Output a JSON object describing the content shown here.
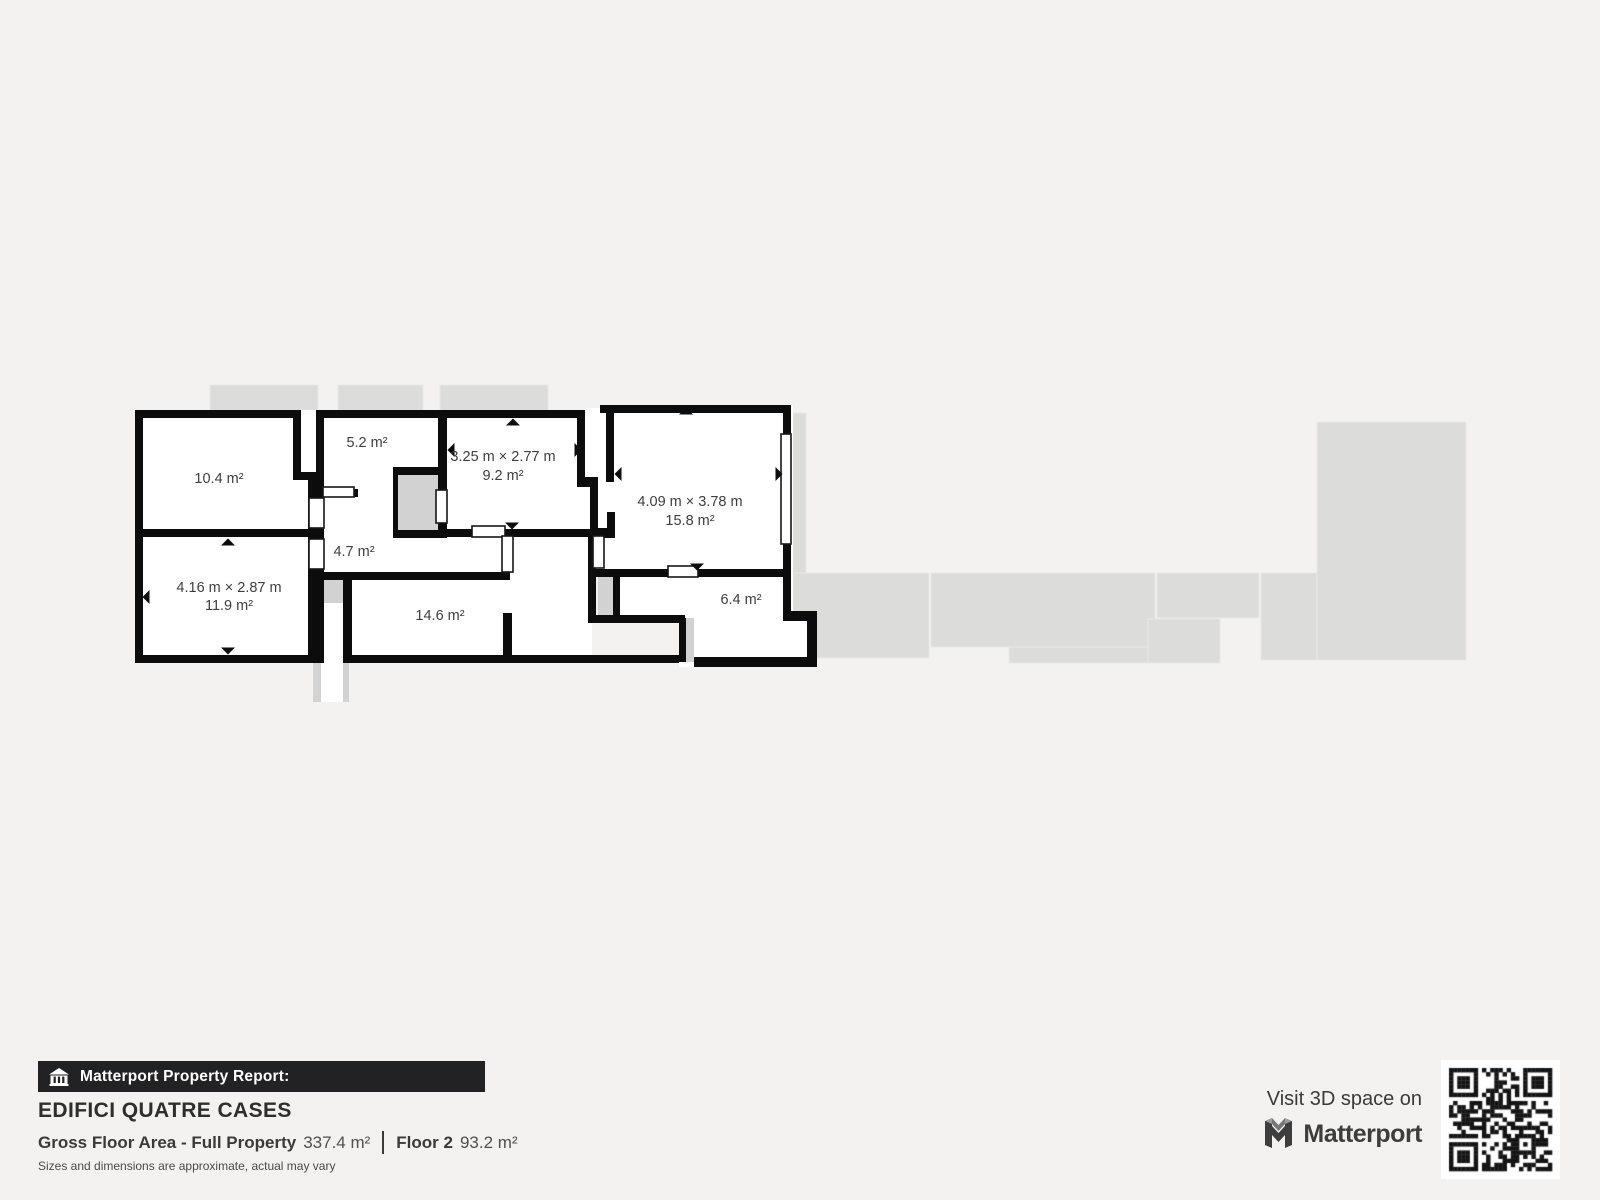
{
  "floorplan": {
    "rooms": [
      {
        "id": "room-10-4",
        "dimensions": "",
        "area_label": "10.4 m²"
      },
      {
        "id": "room-5-2",
        "dimensions": "",
        "area_label": "5.2 m²"
      },
      {
        "id": "room-9-2",
        "dimensions": "3.25 m × 2.77 m",
        "area_label": "9.2 m²"
      },
      {
        "id": "room-15-8",
        "dimensions": "4.09 m × 3.78 m",
        "area_label": "15.8 m²"
      },
      {
        "id": "room-4-7",
        "dimensions": "",
        "area_label": "4.7 m²"
      },
      {
        "id": "room-11-9",
        "dimensions": "4.16 m × 2.87 m",
        "area_label": "11.9 m²"
      },
      {
        "id": "room-14-6",
        "dimensions": "",
        "area_label": "14.6 m²"
      },
      {
        "id": "room-6-4",
        "dimensions": "",
        "area_label": "6.4 m²"
      }
    ]
  },
  "report": {
    "banner_label": "Matterport Property Report:",
    "property_name": "EDIFICI QUATRE CASES",
    "gross_floor_area_label": "Gross Floor Area - Full Property",
    "gross_floor_area_value": "337.4 m²",
    "floor_label": "Floor 2",
    "floor_value": "93.2 m²",
    "disclaimer": "Sizes and dimensions are approximate, actual may vary"
  },
  "cta": {
    "visit_text": "Visit 3D space on",
    "brand": "Matterport"
  },
  "icons": {
    "banner_icon": "home-building-icon",
    "brand_icon": "matterport-m-icon",
    "qr": "qr-code"
  },
  "colors": {
    "background": "#f3f2f0",
    "silhouette": "#dcdcdb",
    "stair_cell": "#d2d2d2",
    "wall": "#0c0c0c",
    "room_fill": "#ffffff",
    "label_text": "#3e3e3e",
    "banner_bg": "#222123",
    "banner_text": "#ffffff"
  }
}
